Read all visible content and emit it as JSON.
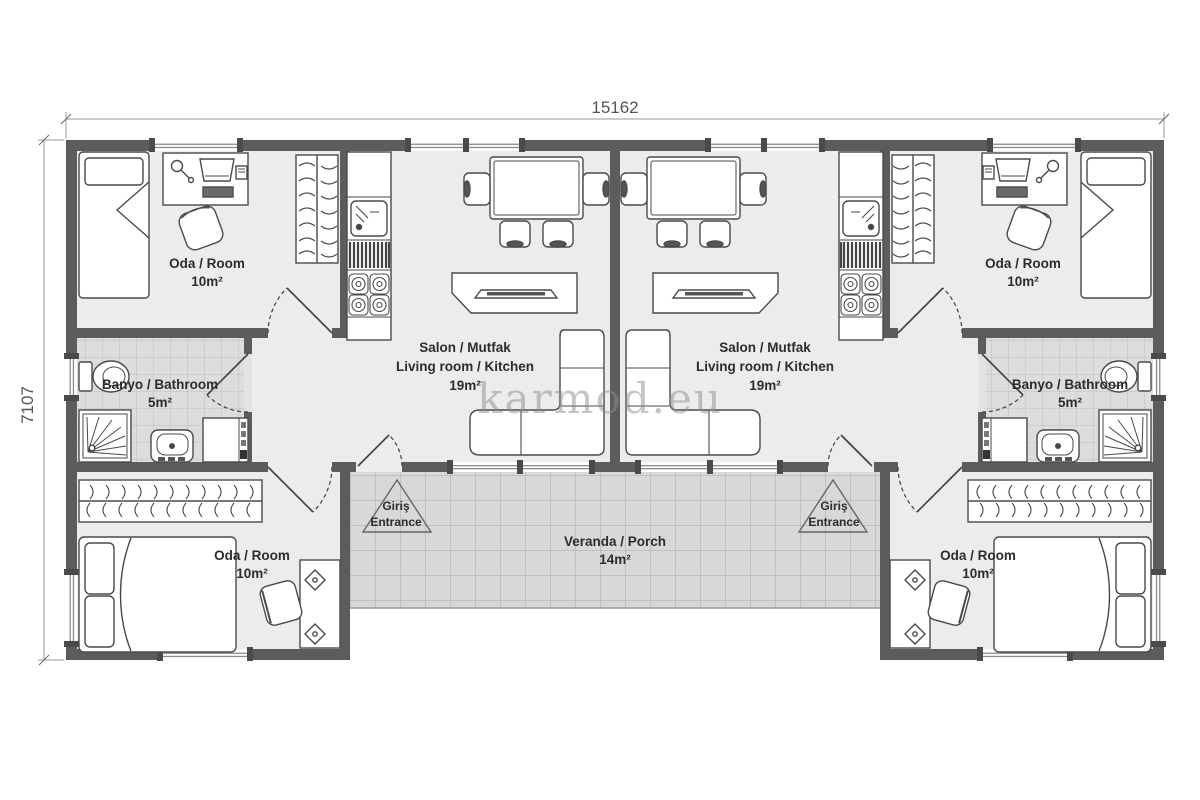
{
  "watermark": {
    "text": "karmod.eu"
  },
  "dimensions": {
    "width": "15162",
    "height": "7107"
  },
  "rooms": {
    "bedroom": {
      "name": "Oda / Room",
      "area": "10m²"
    },
    "bathroom": {
      "name": "Banyo / Bathroom",
      "area": "5m²"
    },
    "living": {
      "name_tr": "Salon / Mutfak",
      "name_en": "Living room / Kitchen",
      "area": "19m²"
    },
    "veranda": {
      "name": "Veranda / Porch",
      "area": "14m²"
    },
    "entrance": {
      "name_tr": "Giriş",
      "name_en": "Entrance"
    }
  },
  "colors": {
    "wall": "#5c5c5c",
    "floor": "#ececec",
    "bath_tile": "#dddddd",
    "veranda_tile": "#d8d8d8",
    "furniture_stroke": "#4a4a4a",
    "label_text": "#2c2c2c",
    "dimension_text": "#555555",
    "watermark": "#8c8c8c"
  }
}
